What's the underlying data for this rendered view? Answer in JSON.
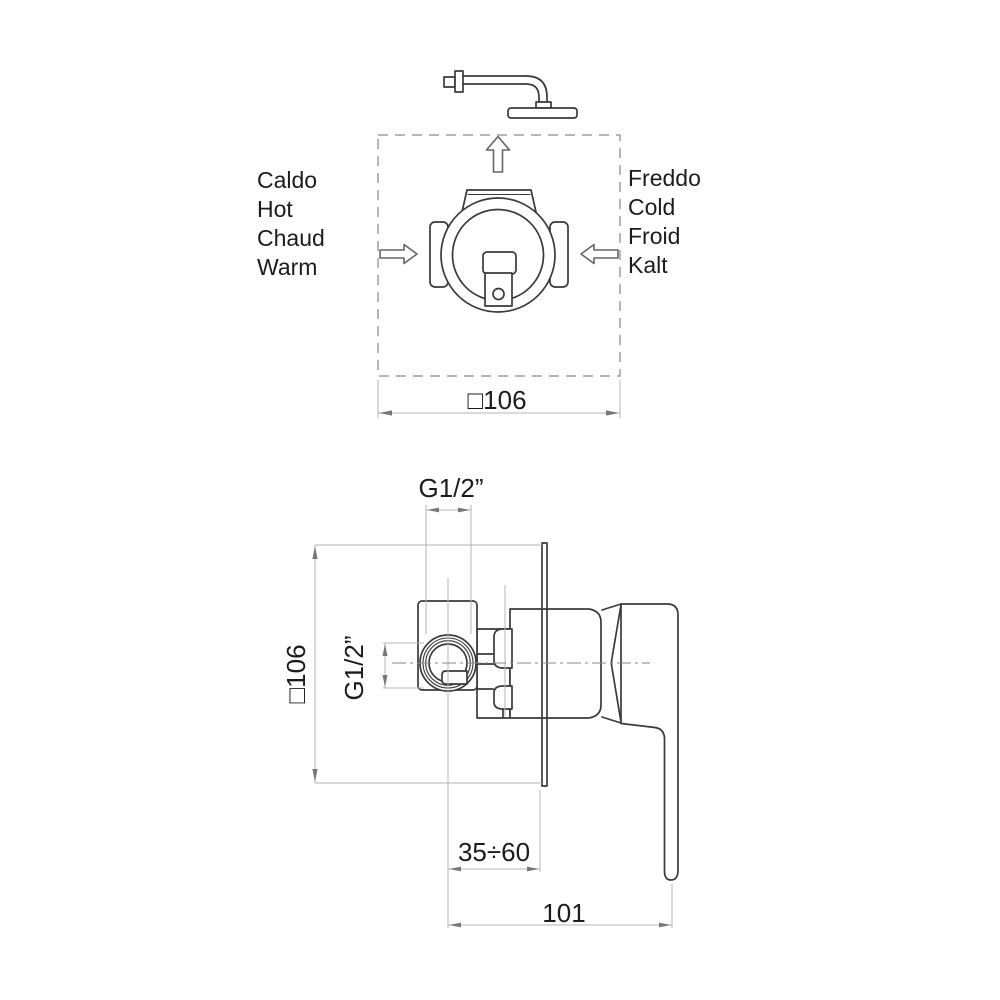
{
  "title": "Shower mixer installation diagram",
  "colors": {
    "object_line": "#3a3a3a",
    "construction_line": "#b5b5b5",
    "text": "#1c1c1c",
    "background": "#ffffff"
  },
  "top_view": {
    "hot": {
      "labels": [
        "Caldo",
        "Hot",
        "Chaud",
        "Warm"
      ]
    },
    "cold": {
      "labels": [
        "Freddo",
        "Cold",
        "Froid",
        "Kalt"
      ]
    },
    "width_dim": "□106"
  },
  "side_view": {
    "square_dim": "□106",
    "thread_side_dim": "G1/2”",
    "thread_top_dim": "G1/2”",
    "depth_dim": "35÷60",
    "length_dim": "101"
  }
}
